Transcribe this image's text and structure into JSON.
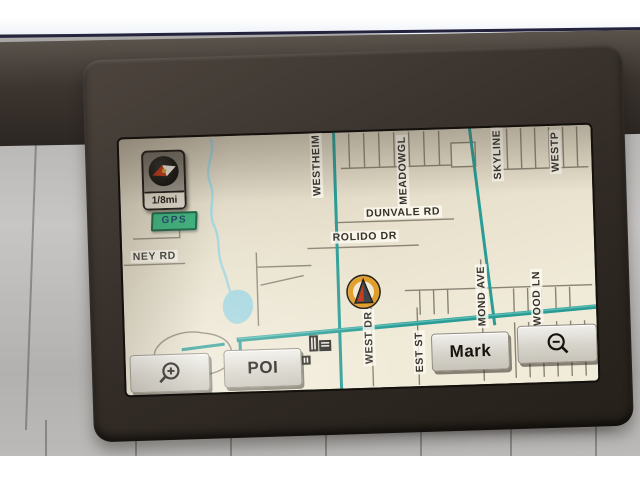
{
  "screen": {
    "scale_label": "1/8mi",
    "gps_badge": "GPS",
    "buttons": {
      "poi": "POI",
      "mark": "Mark"
    },
    "map_labels": {
      "ney_rd": "NEY RD",
      "dunvale_rd": "DUNVALE RD",
      "rolido_dr": "ROLIDO DR",
      "westheimer": "WESTHEIM",
      "meadowglen": "MEADOWGL",
      "skyline": "SKYLINE",
      "westpark": "WESTP",
      "west_dr": "WEST DR",
      "west_st": "EST ST",
      "richmond_ave": "MOND AVE",
      "wood_ln": "WOOD LN"
    },
    "colors": {
      "map_background": "#e9e2cf",
      "major_road": "#2a9c96",
      "minor_road": "#8a8273",
      "water": "#9ed3de",
      "marker_ring": "#e09a22",
      "marker_arrow": "#323c46",
      "marker_tip": "#c5330f",
      "gps_green": "#2fae74"
    }
  }
}
